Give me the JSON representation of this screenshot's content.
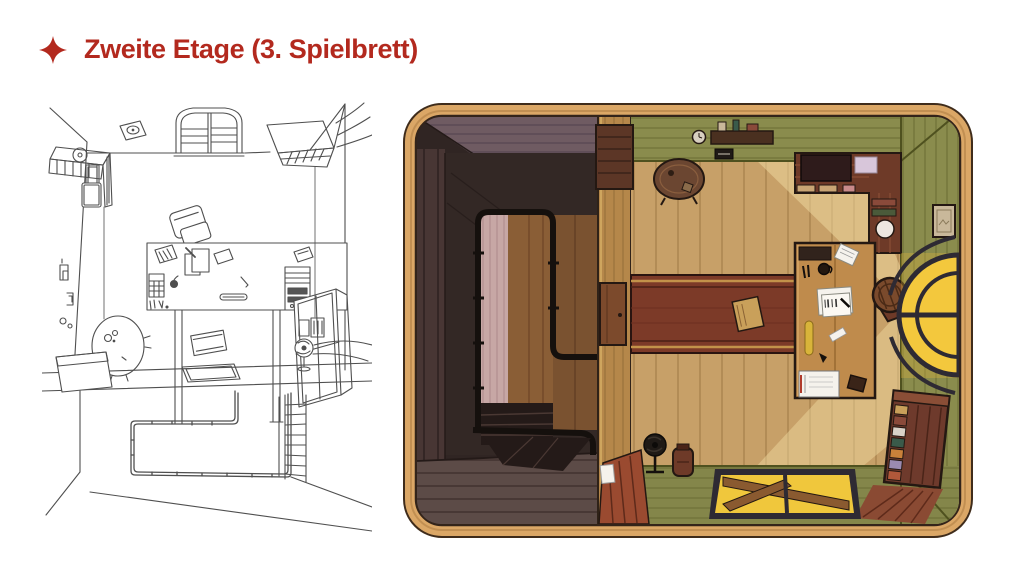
{
  "slide": {
    "title": "Zweite Etage (3. Spielbrett)",
    "title_color": "#B3291E",
    "bullet_icon": "four-point-star-icon",
    "background_color": "#FFFFFF"
  },
  "figures": {
    "sketch": {
      "description": "Black-and-white concept line sketch of the attic office: arched window, desk with computer tower and papers, tilted chair, wall counter and cabinet on the left, round table, open side window, fan, floor hatch, stair railing and ladder below the ledge",
      "stroke_color": "#4F4F4F"
    },
    "board": {
      "description": "Painted top-down game board of the second floor: dark stairwell with black railing on the left, wooden office with olive-green walls, desk covered with papers, round-back chair, round table, wall shelf, L-shaped sideboard, glowing arched window, red runner rug, bookshelf and yellow glass hatch",
      "colors": {
        "frame_wood": "#DBA766",
        "frame_outline": "#3F2C1B",
        "stairwell_dark": "#302523",
        "stairwell_wall_mauve": "#6F5B62",
        "stairwell_floor": "#5C4B47",
        "opening_pink": "#C7A7A5",
        "opening_wood": "#8A5E36",
        "railing_black": "#15100D",
        "divider_wood": "#B5874A",
        "wall_green": "#8A8C4D",
        "floor_wood": "#C7A068",
        "sunlight": "#F2DCA2",
        "runner_red": "#7C3A28",
        "desk_wood": "#BF8B4C",
        "window_glow": "#F3C83D",
        "furniture_brown": "#6E3A28"
      }
    }
  }
}
